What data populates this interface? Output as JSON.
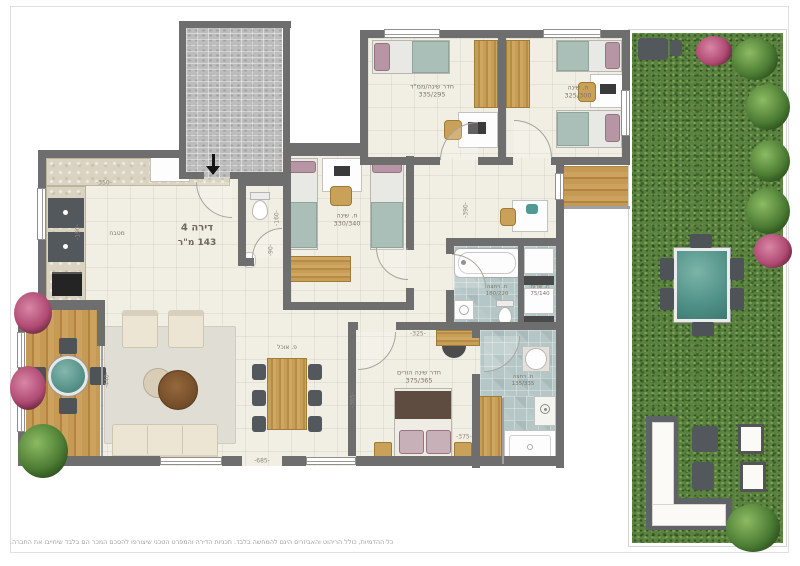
{
  "apartment": {
    "number_label": "דירה 4",
    "area_label": "143 מ\"ר"
  },
  "rooms": {
    "kitchen": {
      "label": "מטבח"
    },
    "dining": {
      "label": "פ. אוכל"
    },
    "bedroom_safe": {
      "label": "חדר שינה/ממ\"ד",
      "dims": "335/295"
    },
    "bedroom_right": {
      "label": "ח. שינה",
      "dims": "325/300"
    },
    "bedroom_middle": {
      "label": "ח. שינה",
      "dims": "330/340"
    },
    "master_bedroom": {
      "label": "חדר שינה הורים",
      "dims": "375/365"
    },
    "bathroom_top": {
      "label": "ח. רחצה",
      "dims": "180/220"
    },
    "service_room": {
      "label": "ח. שרות",
      "dims": "75/140"
    },
    "bathroom_bottom": {
      "label": "ח. רחצה",
      "dims": "135/335"
    }
  },
  "dims": {
    "kitchen_top": "350",
    "kitchen_side": "190",
    "wc_side": "160",
    "wc_door": "90",
    "hall": "390",
    "master_top": "325",
    "master_right": "375",
    "master_left": "365",
    "living_left": "440",
    "living_bottom": "685"
  },
  "footer": {
    "disclaimer": "כל ההדמיות, כולל הריהוט והאביזרים הינם להמחשה בלבד. תכניות הדירה והמפרט הטכני שיצורפו להסכם המכר הם בלבד שיחייבו את החברה."
  },
  "colors": {
    "wall": "#6e6e6e",
    "floor": "#f1eee3",
    "bath_tile": "#b4c6c5",
    "wood": "#c49a55",
    "grass": "#5a8140",
    "teal_accent": "#58a39d"
  }
}
